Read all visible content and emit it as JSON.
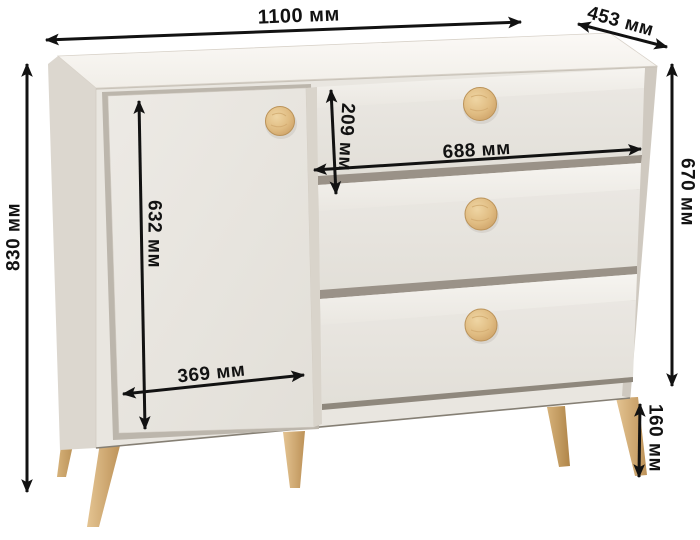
{
  "diagram": {
    "product": "dresser with one door and three drawers on wooden legs",
    "unit": "мм",
    "dimensions": {
      "width": "1100 мм",
      "depth": "453 мм",
      "total_height": "830 мм",
      "body_height": "670 мм",
      "door_height": "632 мм",
      "door_width": "369 мм",
      "top_drawer_height": "209 мм",
      "drawer_width": "688 мм",
      "leg_height": "160 мм"
    },
    "colors": {
      "background": "#ffffff",
      "body": "#e9e6e0",
      "top_panel": "#f7f5f1",
      "side_panel": "#dcd7cf",
      "gap_shadow": "#978f84",
      "wood_knob": "#e2bf85",
      "wood_leg": "#d9b67f",
      "dimension_ink": "#121212"
    }
  }
}
